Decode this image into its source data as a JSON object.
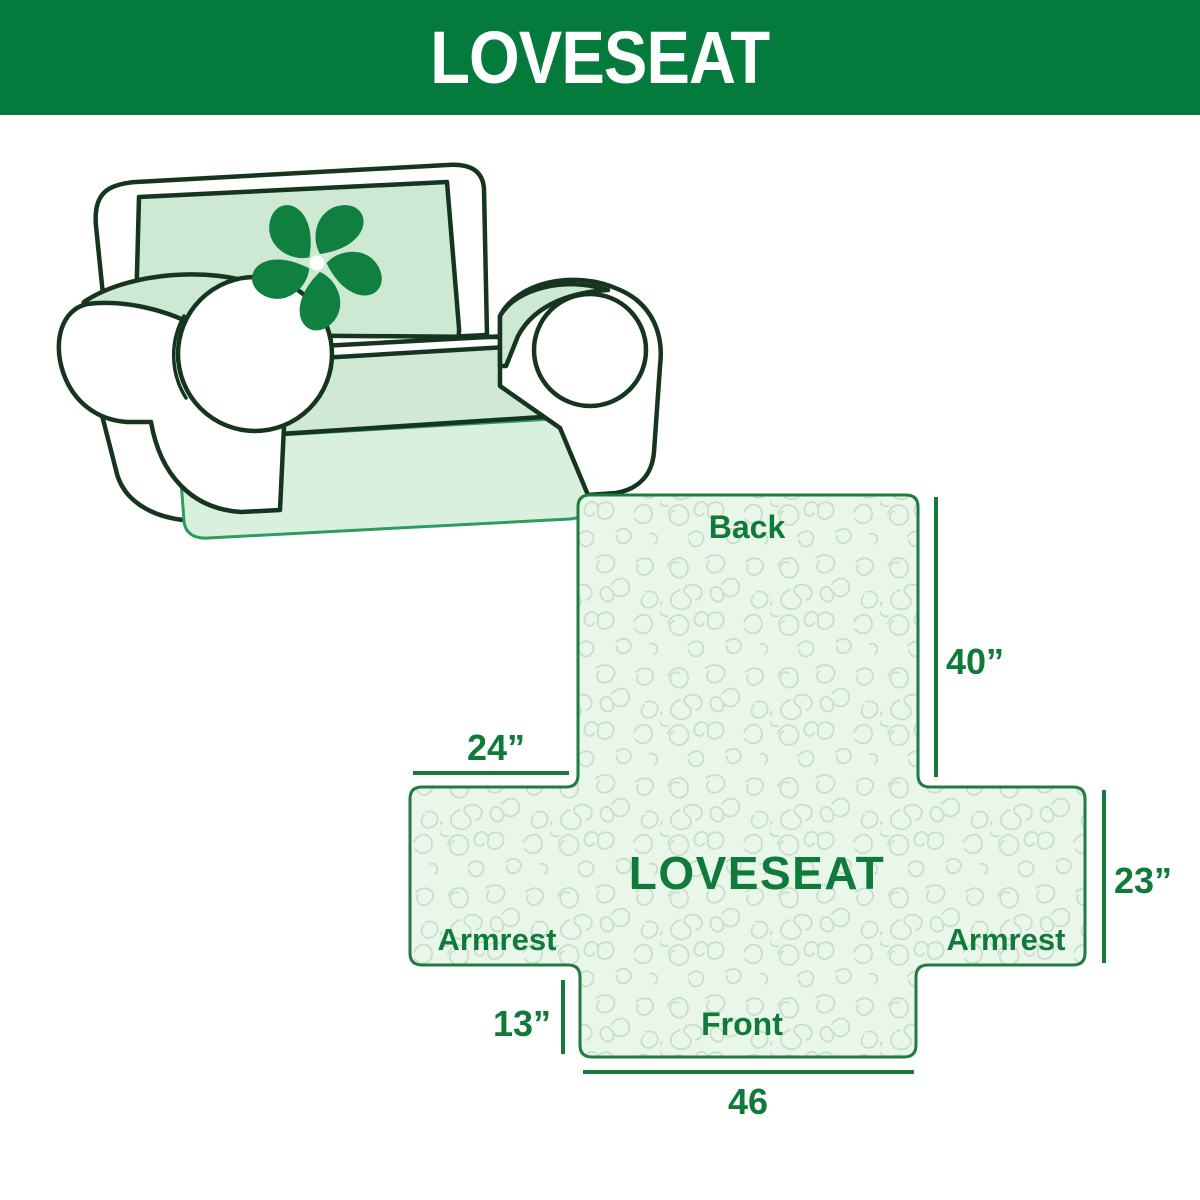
{
  "banner": {
    "title": "LOVESEAT"
  },
  "illustration": {
    "alt": "Loveseat sofa wearing a mint quilted slipcover",
    "logo_icon": "pinwheel-icon"
  },
  "diagram": {
    "center_label": "LOVESEAT",
    "back_label": "Back",
    "front_label": "Front",
    "armrest_left_label": "Armrest",
    "armrest_right_label": "Armrest",
    "dimensions": {
      "back_height": "40”",
      "armrest_top_width": "24”",
      "seat_side_width": "23”",
      "front_drop": "13”",
      "front_width": "46"
    }
  },
  "colors": {
    "banner_green": "#047a3d",
    "label_green": "#0f7a3a",
    "diagram_fill": "#e9f6ea",
    "diagram_pattern_line": "#c8ddca",
    "diagram_border": "#217b41",
    "dimension_line_green": "#167a3c",
    "slipcover_mint": "#cde8d3",
    "slipcover_drape": "#daf0de",
    "seat_mint": "#cfe9d5",
    "outline_dark": "#16351f",
    "pinwheel_green": "#0f8040",
    "seam_green": "#2f9c5f"
  }
}
